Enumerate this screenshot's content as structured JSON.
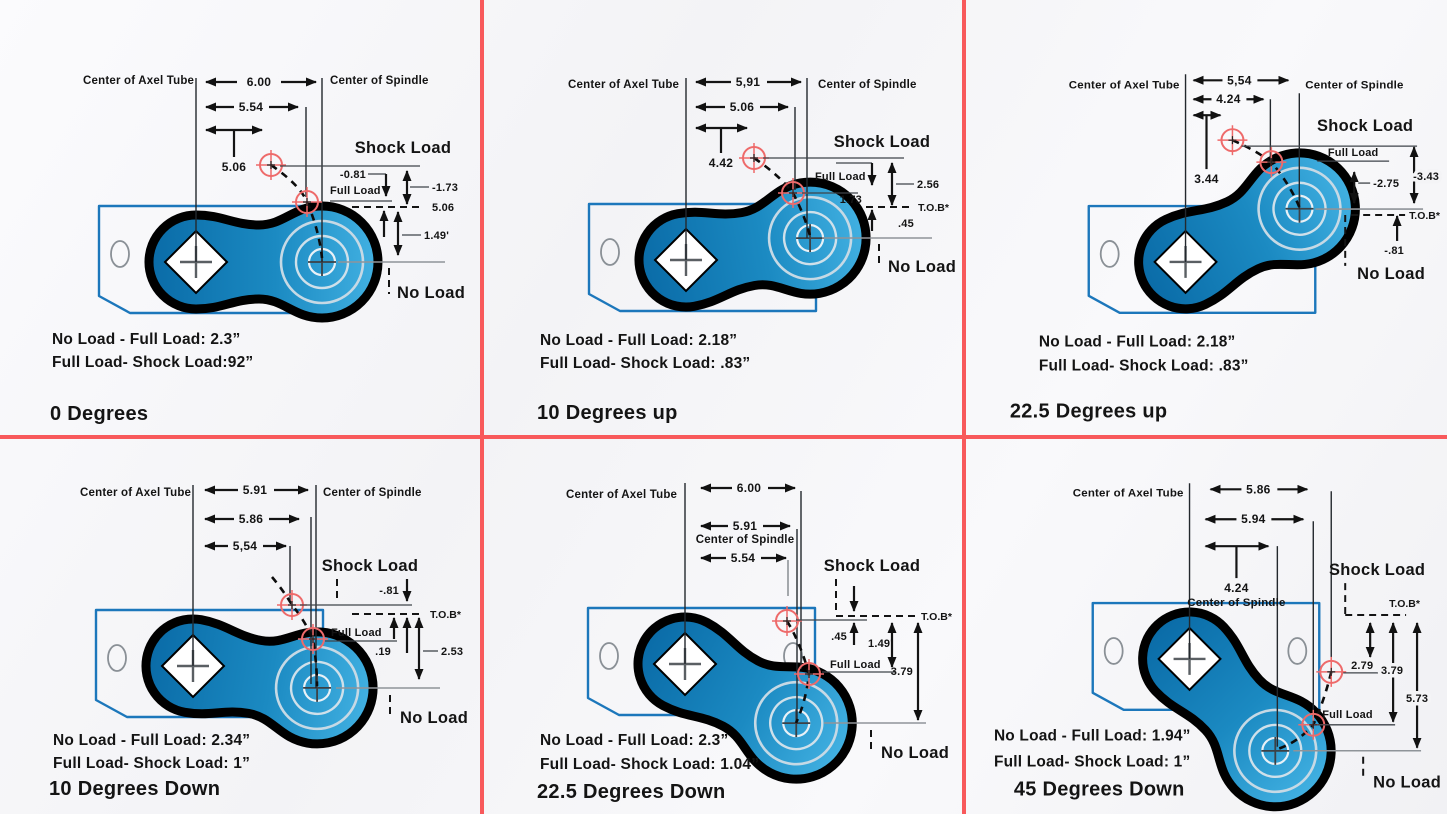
{
  "colors": {
    "divider": "#f8595b",
    "arm_dark": "#0a6ba7",
    "arm_light": "#42b1e2",
    "bracket_blue": "#1c77bb",
    "crosshair_red": "#ee6a6a",
    "spindle_ring": "#c6d9e5"
  },
  "panels": [
    {
      "id": "0-degrees",
      "title": "0 Degrees",
      "axel_label": "Center of Axel Tube",
      "spindle_label": "Center of Spindle",
      "dim1": "6.00",
      "dim2": "5.54",
      "dim3": "5.06",
      "shock_label": "Shock Load",
      "full_label": "Full Load",
      "no_label": "No Load",
      "v1": "-0.81",
      "v2": "-1.73",
      "v3": "5.06",
      "v4": "1.49'",
      "note1": "No Load - Full Load: 2.3”",
      "note2": "Full Load- Shock Load:92”"
    },
    {
      "id": "10-degrees-up",
      "title": "10 Degrees up",
      "axel_label": "Center of Axel Tube",
      "spindle_label": "Center of Spindle",
      "dim1": "5,91",
      "dim2": "5.06",
      "dim3": "4.42",
      "shock_label": "Shock Load",
      "full_label": "Full Load",
      "no_label": "No Load",
      "v1": "2.56",
      "v2": "1.73",
      "v3": "T.O.B*",
      "v4": ".45",
      "note1": "No Load - Full Load: 2.18”",
      "note2": "Full Load- Shock Load: .83”"
    },
    {
      "id": "22-5-degrees-up",
      "title": "22.5 Degrees up",
      "axel_label": "Center of Axel Tube",
      "spindle_label": "Center of Spindle",
      "dim1": "5,54",
      "dim2": "4.24",
      "dim3": "3.44",
      "shock_label": "Shock Load",
      "full_label": "Full Load",
      "no_label": "No Load",
      "v1": "-3.43",
      "v2": "-2.75",
      "v3": "T.O.B*",
      "v4": "-.81",
      "note1": "No Load - Full Load: 2.18”",
      "note2": "Full Load- Shock Load: .83”"
    },
    {
      "id": "10-degrees-down",
      "title": "10 Degrees Down",
      "axel_label": "Center of Axel Tube",
      "spindle_label": "Center of Spindle",
      "dim1": "5.91",
      "dim2": "5.86",
      "dim3": "5,54",
      "shock_label": "Shock Load",
      "full_label": "Full Load",
      "no_label": "No Load",
      "v1": "-.81",
      "v2": "T.O.B*",
      "v3": ".19",
      "v4": "2.53",
      "note1": "No Load - Full Load: 2.34”",
      "note2": "Full Load- Shock Load: 1”"
    },
    {
      "id": "22-5-degrees-down",
      "title": "22.5 Degrees Down",
      "axel_label": "Center of Axel Tube",
      "spindle_label": "Center of Spindle",
      "dim1": "6.00",
      "dim2": "5.91",
      "dim3": "5.54",
      "shock_label": "Shock Load",
      "full_label": "Full Load",
      "no_label": "No Load",
      "v1": "T.O.B*",
      "v2": ".45",
      "v3": "1.49'",
      "v4": "3.79",
      "note1": "No Load - Full Load: 2.3”",
      "note2": "Full Load- Shock Load: 1.04”"
    },
    {
      "id": "45-degrees-down",
      "title": "45 Degrees Down",
      "axel_label": "Center of Axel Tube",
      "spindle_label": "Center of Spindle",
      "dim1": "5.86",
      "dim2": "5.94",
      "dim3": "4.24",
      "shock_label": "Shock Load",
      "full_label": "Full Load",
      "no_label": "No Load",
      "v1": "T.O.B*",
      "v2": "2.79",
      "v3": "3.79",
      "v4": "5.73",
      "note1": "No Load - Full Load: 1.94”",
      "note2": "Full Load- Shock Load: 1”"
    }
  ]
}
